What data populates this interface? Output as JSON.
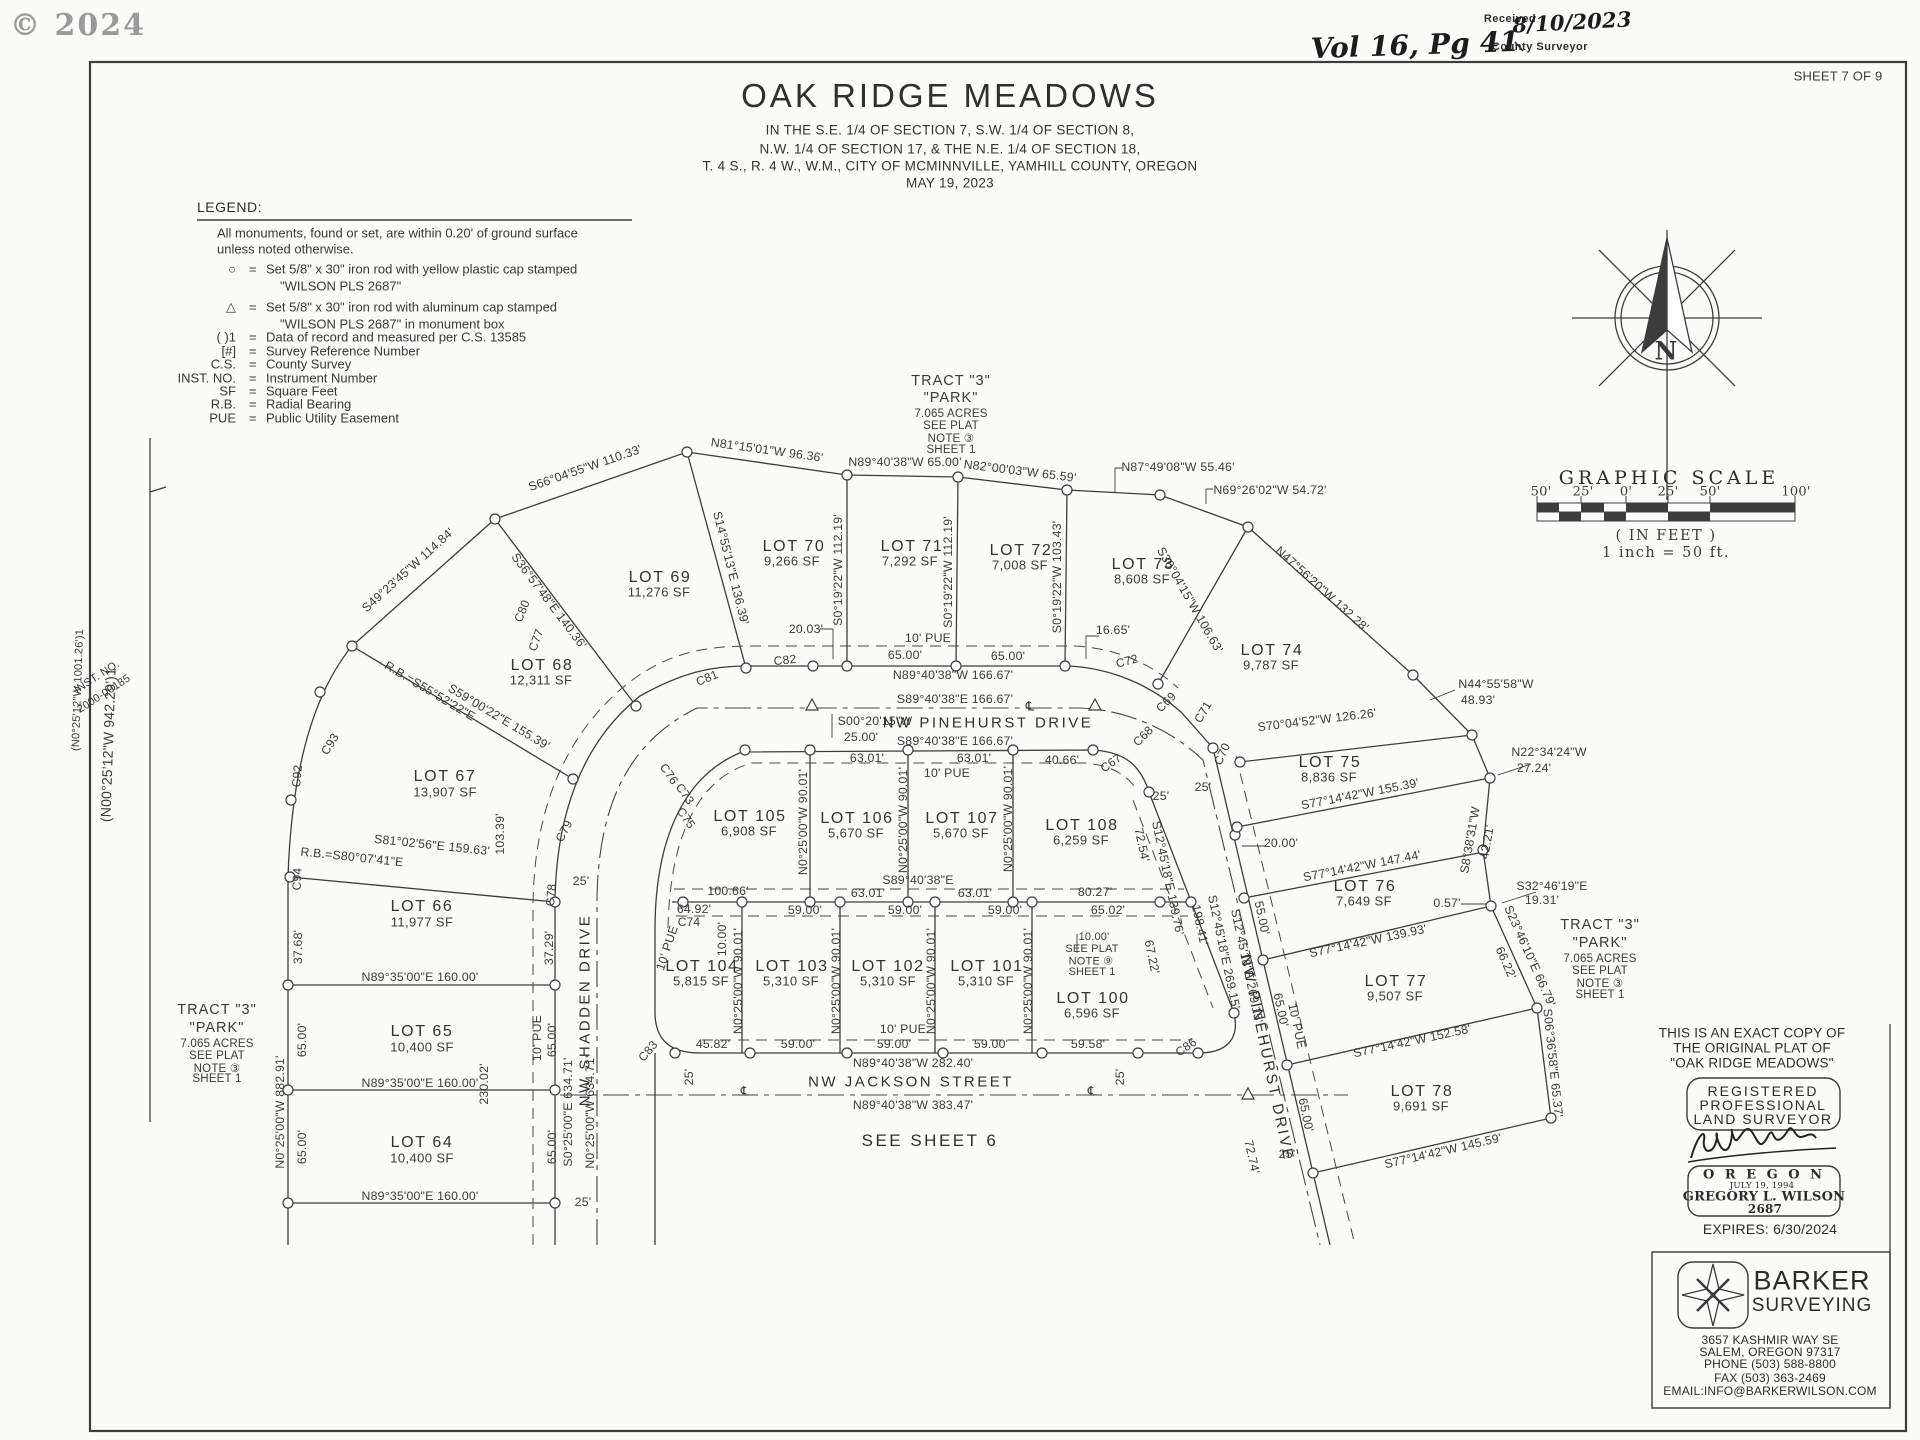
{
  "sheet": {
    "copyright": "© 2024",
    "volume_note": "Vol 16, Pg 41",
    "received": {
      "label": "Received",
      "date": "8/10/2023",
      "office": "County Surveyor"
    },
    "sheet_no": "SHEET 7 OF 9"
  },
  "title_block": {
    "title": "OAK RIDGE MEADOWS",
    "subtitle": [
      "IN THE S.E. 1/4 OF SECTION 7, S.W. 1/4 OF SECTION 8,",
      "N.W. 1/4 OF SECTION 17, & THE N.E. 1/4 OF SECTION 18,",
      "T. 4 S., R. 4 W., W.M., CITY OF MCMINNVILLE, YAMHILL  COUNTY, OREGON",
      "MAY 19, 2023"
    ]
  },
  "legend": {
    "title": "LEGEND:",
    "intro": [
      "All monuments, found or set, are within 0.20' of ground surface",
      "unless noted otherwise."
    ],
    "items": [
      {
        "key": "○",
        "text": "Set 5/8\" x 30\" iron rod with yellow plastic cap stamped",
        "text2": "\"WILSON PLS 2687\""
      },
      {
        "key": "△",
        "text": "Set 5/8\" x 30\" iron rod with aluminum cap stamped",
        "text2": "\"WILSON PLS 2687\" in monument box"
      },
      {
        "key": "(  )1",
        "text": "Data of record and measured per C.S. 13585"
      },
      {
        "key": "[#]",
        "text": "Survey Reference Number"
      },
      {
        "key": "C.S.",
        "text": "County Survey"
      },
      {
        "key": "INST. NO.",
        "text": "Instrument Number"
      },
      {
        "key": "SF",
        "text": "Square Feet"
      },
      {
        "key": "R.B.",
        "text": "Radial Bearing"
      },
      {
        "key": "PUE",
        "text": "Public Utility Easement"
      }
    ]
  },
  "north_arrow": {
    "label": "N"
  },
  "graphic_scale": {
    "title": "GRAPHIC SCALE",
    "ticks": [
      "50'",
      "25'",
      "0'",
      "25'",
      "50'",
      "100'"
    ],
    "units": "( IN FEET )",
    "ratio": "1 inch = 50 ft."
  },
  "streets": {
    "pinehurst_top": "NW PINEHURST DRIVE",
    "pinehurst_east": "NW PINEHURST DRIVE",
    "shadden": "NW SHADDEN DRIVE",
    "jackson": "NW JACKSON STREET"
  },
  "notes": {
    "see_sheet": "SEE SHEET 6",
    "tract": [
      "TRACT \"3\"",
      "\"PARK\"",
      "7.065 ACRES",
      "SEE PLAT",
      "NOTE ③",
      "SHEET 1"
    ],
    "plat_note9": [
      "10.00'",
      "SEE PLAT",
      "NOTE ⑨",
      "SHEET 1"
    ],
    "inst_no": [
      "INST. NO.",
      "2000-00185"
    ],
    "record_left_outer": "(N0°25'12\"W 1001.26')1",
    "record_left_inner": "(N00°25'12\"W 942.29')1"
  },
  "lots_outer": [
    {
      "name": "LOT 64",
      "sf": "10,400 SF"
    },
    {
      "name": "LOT 65",
      "sf": "10,400 SF"
    },
    {
      "name": "LOT 66",
      "sf": "11,977 SF"
    },
    {
      "name": "LOT 67",
      "sf": "13,907 SF"
    },
    {
      "name": "LOT 68",
      "sf": "12,311 SF"
    },
    {
      "name": "LOT 69",
      "sf": "11,276 SF"
    },
    {
      "name": "LOT 70",
      "sf": "9,266 SF"
    },
    {
      "name": "LOT 71",
      "sf": "7,292 SF"
    },
    {
      "name": "LOT 72",
      "sf": "7,008 SF"
    },
    {
      "name": "LOT 73",
      "sf": "8,608 SF"
    },
    {
      "name": "LOT 74",
      "sf": "9,787 SF"
    },
    {
      "name": "LOT 75",
      "sf": "8,836 SF"
    },
    {
      "name": "LOT 76",
      "sf": "7,649 SF"
    },
    {
      "name": "LOT 77",
      "sf": "9,507 SF"
    },
    {
      "name": "LOT 78",
      "sf": "9,691 SF"
    }
  ],
  "lots_inner": [
    {
      "name": "LOT 100",
      "sf": "6,596 SF"
    },
    {
      "name": "LOT 101",
      "sf": "5,310 SF"
    },
    {
      "name": "LOT 102",
      "sf": "5,310 SF"
    },
    {
      "name": "LOT 103",
      "sf": "5,310 SF"
    },
    {
      "name": "LOT 104",
      "sf": "5,815 SF"
    },
    {
      "name": "LOT 105",
      "sf": "6,908 SF"
    },
    {
      "name": "LOT 106",
      "sf": "5,670 SF"
    },
    {
      "name": "LOT 107",
      "sf": "5,670 SF"
    },
    {
      "name": "LOT 108",
      "sf": "6,259 SF"
    }
  ],
  "dims": {
    "outer_arc": [
      "S49°23'45\"W 114.84'",
      "S66°04'55\"W 110.33'",
      "N81°15'01\"W 96.36'",
      "N89°40'38\"W 65.00'",
      "N82°00'03\"W 65.59'",
      "N87°49'08\"W 55.46'",
      "N69°26'02\"W 54.72'",
      "N47°56'20\"W 132.28'",
      "N44°55'58\"W",
      "48.93'",
      "N22°34'24\"W",
      "27.24'"
    ],
    "radial": [
      "S36°57'48\"E 140.36'",
      "S14°55'13\"E 136.39'",
      "S0°19'22\"W 112.19'",
      "S0°19'22\"W 112.19'",
      "S0°19'22\"W 103.43'",
      "S30°04'15\"W 106.63'",
      "R.B.=S55°52'22\"E",
      "S59°00'22\"E 155.39'",
      "R.B.=S80°07'41\"E",
      "S81°02'56\"E 159.63'"
    ],
    "east_lots": [
      "S70°04'52\"W 126.26'",
      "S77°14'42\"W 155.39'",
      "20.00'",
      "S77°14'42\"W 147.44'",
      "S8°38'31\"W",
      "42.21'",
      "S32°46'19\"E",
      "19.31'",
      "0.57'",
      "S77°14'42\"W 139.93'",
      "S23°46'10\"E 66.79'",
      "66.22'",
      "S77°14'42\"W 152.58'",
      "S06°36'58\"E 65.37'",
      "S77°14'42\"W 145.59'"
    ],
    "west_lots": [
      "N89°35'00\"E 160.00'",
      "N89°35'00\"E 160.00'",
      "N89°35'00\"E 160.00'",
      "N0°25'00\"W 882.91'",
      "37.68'",
      "65.00'",
      "65.00'",
      "65.00'",
      "65.00'",
      "37.29'",
      "25'",
      "25'",
      "103.39'",
      "230.02'",
      "S0°25'00\"E 634.71'",
      "N0°25'00\"W 634.71'",
      "10' PUE"
    ],
    "pinehurst_top": [
      "N89°40'38\"W 166.67'",
      "S89°40'38\"E 166.67'",
      "S89°40'38\"E 166.67'",
      "S00°20'15\"W",
      "25.00'",
      "20.03'",
      "16.65'",
      "10' PUE",
      "65.00'",
      "65.00'"
    ],
    "inner_top": [
      "63.01'",
      "63.01'",
      "40.66'",
      "10' PUE",
      "N0°25'00\"W 90.01'",
      "N0°25'00\"W 90.01'",
      "N0°25'00\"W 90.01'",
      "100.66'",
      "S89°40'38\"E",
      "63.01'",
      "63.01'",
      "80.27'"
    ],
    "inner_mid": [
      "64.92'",
      "59.00'",
      "59.00'",
      "59.00'",
      "65.02'",
      "10.00'",
      "10' PUE"
    ],
    "inner_bottom": [
      "N0°25'00\"W 90.01'",
      "N0°25'00\"W 90.01'",
      "N0°25'00\"W 90.01'",
      "N0°25'00\"W 90.01'",
      "10' PUE",
      "45.82'",
      "59.00'",
      "59.00'",
      "59.00'",
      "59.58'"
    ],
    "jackson": [
      "N89°40'38\"W 282.40'",
      "N89°40'38\"W 383.47'",
      "25'",
      "25'"
    ],
    "pinehurst_east": [
      "72.54'",
      "S12°45'18\"E 139.76'",
      "198.41'",
      "S12°45'18\"E 269.15'",
      "S12°45'18\"E 269.15'",
      "55.00'",
      "65.00'",
      "10' PUE",
      "65.00'",
      "67.22'",
      "72.74'",
      "25'",
      "25'",
      "25'"
    ]
  },
  "curves": [
    "C67",
    "C68",
    "C69",
    "C70",
    "C71",
    "C72",
    "C73",
    "C74",
    "C75",
    "C76",
    "C77",
    "C78",
    "C79",
    "C80",
    "C81",
    "C82",
    "C83",
    "C86",
    "C92",
    "C93",
    "C94"
  ],
  "misc": {
    "cl": "℄",
    "eq": "="
  },
  "right_column": {
    "copy_note": [
      "THIS IS AN EXACT COPY OF",
      "THE ORIGINAL PLAT OF",
      "\"OAK RIDGE MEADOWS\""
    ],
    "stamp": {
      "l1": "REGISTERED",
      "l2": "PROFESSIONAL",
      "l3": "LAND SURVEYOR",
      "state": "O R E G O N",
      "date": "JULY 19, 1994",
      "name": "GREGORY L. WILSON",
      "number": "2687"
    },
    "expires": "EXPIRES: 6/30/2024",
    "firm": {
      "name1": "BARKER",
      "name2": "SURVEYING",
      "address": [
        "3657 KASHMIR WAY SE",
        "SALEM, OREGON 97317",
        "PHONE (503) 588-8800",
        "FAX  (503) 363-2469",
        "EMAIL:INFO@BARKERWILSON.COM"
      ]
    }
  }
}
